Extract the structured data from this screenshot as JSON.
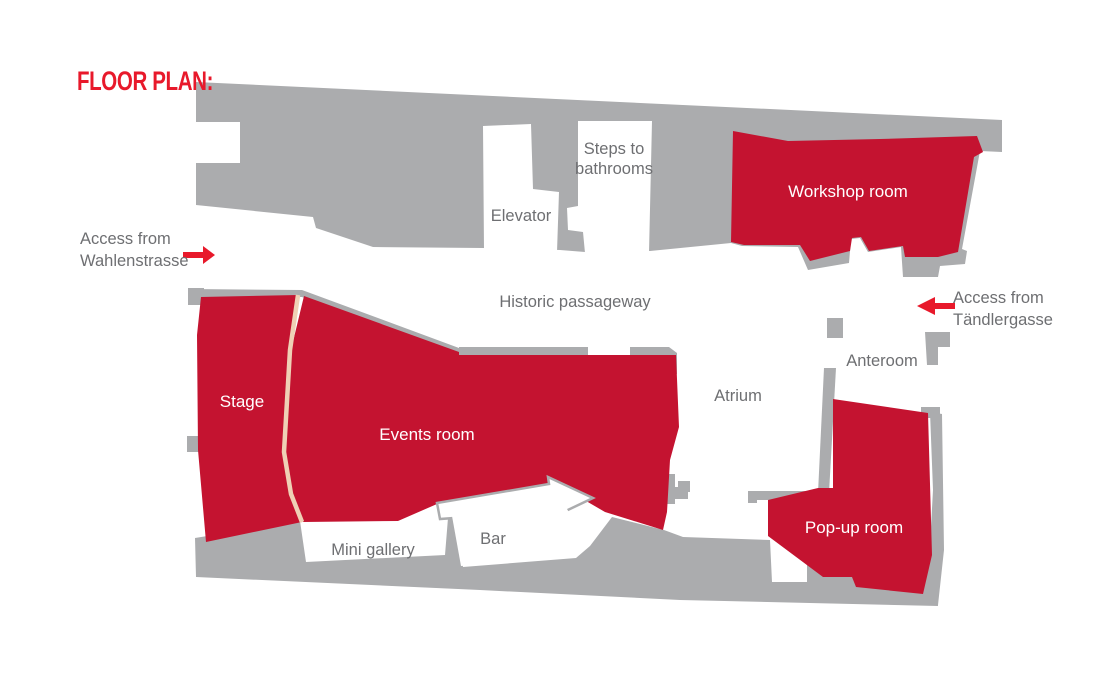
{
  "title": "FLOOR PLAN:",
  "colors": {
    "accent_red": "#E8192B",
    "room_red": "#C41330",
    "building_gray": "#ABACAE",
    "text_gray": "#6E6F72",
    "divider_beige": "#EFD0B5",
    "white": "#FFFFFF"
  },
  "rooms": {
    "workshop": {
      "label": "Workshop room"
    },
    "stage": {
      "label": "Stage"
    },
    "events": {
      "label": "Events room"
    },
    "popup": {
      "label": "Pop-up room"
    }
  },
  "areas": {
    "elevator": {
      "label": "Elevator"
    },
    "steps": {
      "label": "Steps to\nbathrooms"
    },
    "passageway": {
      "label": "Historic passageway"
    },
    "atrium": {
      "label": "Atrium"
    },
    "anteroom": {
      "label": "Anteroom"
    },
    "mini_gallery": {
      "label": "Mini gallery"
    },
    "bar": {
      "label": "Bar"
    }
  },
  "access": {
    "wahlenstrasse": {
      "label": "Access from\nWahlenstrasse",
      "arrow_direction": "right"
    },
    "taendlergasse": {
      "label": "Access from\nTändlergasse",
      "arrow_direction": "left"
    }
  }
}
